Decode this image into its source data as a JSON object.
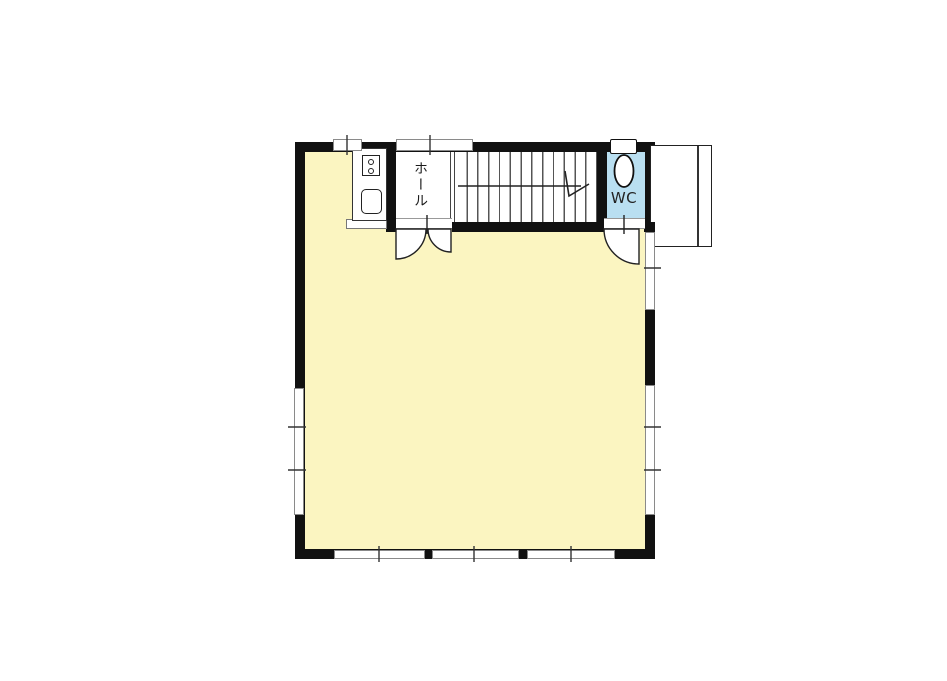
{
  "plan": {
    "type": "floor-plan",
    "labels": {
      "hall": "ホール",
      "wc": "WC"
    },
    "rooms": [
      {
        "name": "main-room",
        "label": "",
        "fill": "#FBF5C1"
      },
      {
        "name": "hall",
        "label": "ホール",
        "fill": "#FFFFFF"
      },
      {
        "name": "staircase",
        "label": "",
        "fill": "#FFFFFF"
      },
      {
        "name": "wc",
        "label": "WC",
        "fill": "#B9DFF1"
      }
    ],
    "fixtures": [
      "stove-icon",
      "sink-icon",
      "toilet-icon",
      "stair-direction-arrow"
    ],
    "colors": {
      "room_fill": "#FBF5C1",
      "wc_fill": "#B9DFF1",
      "wall": "#111111",
      "line": "#444444",
      "window_border": "#8A8A8A",
      "background": "#FFFFFF"
    }
  }
}
